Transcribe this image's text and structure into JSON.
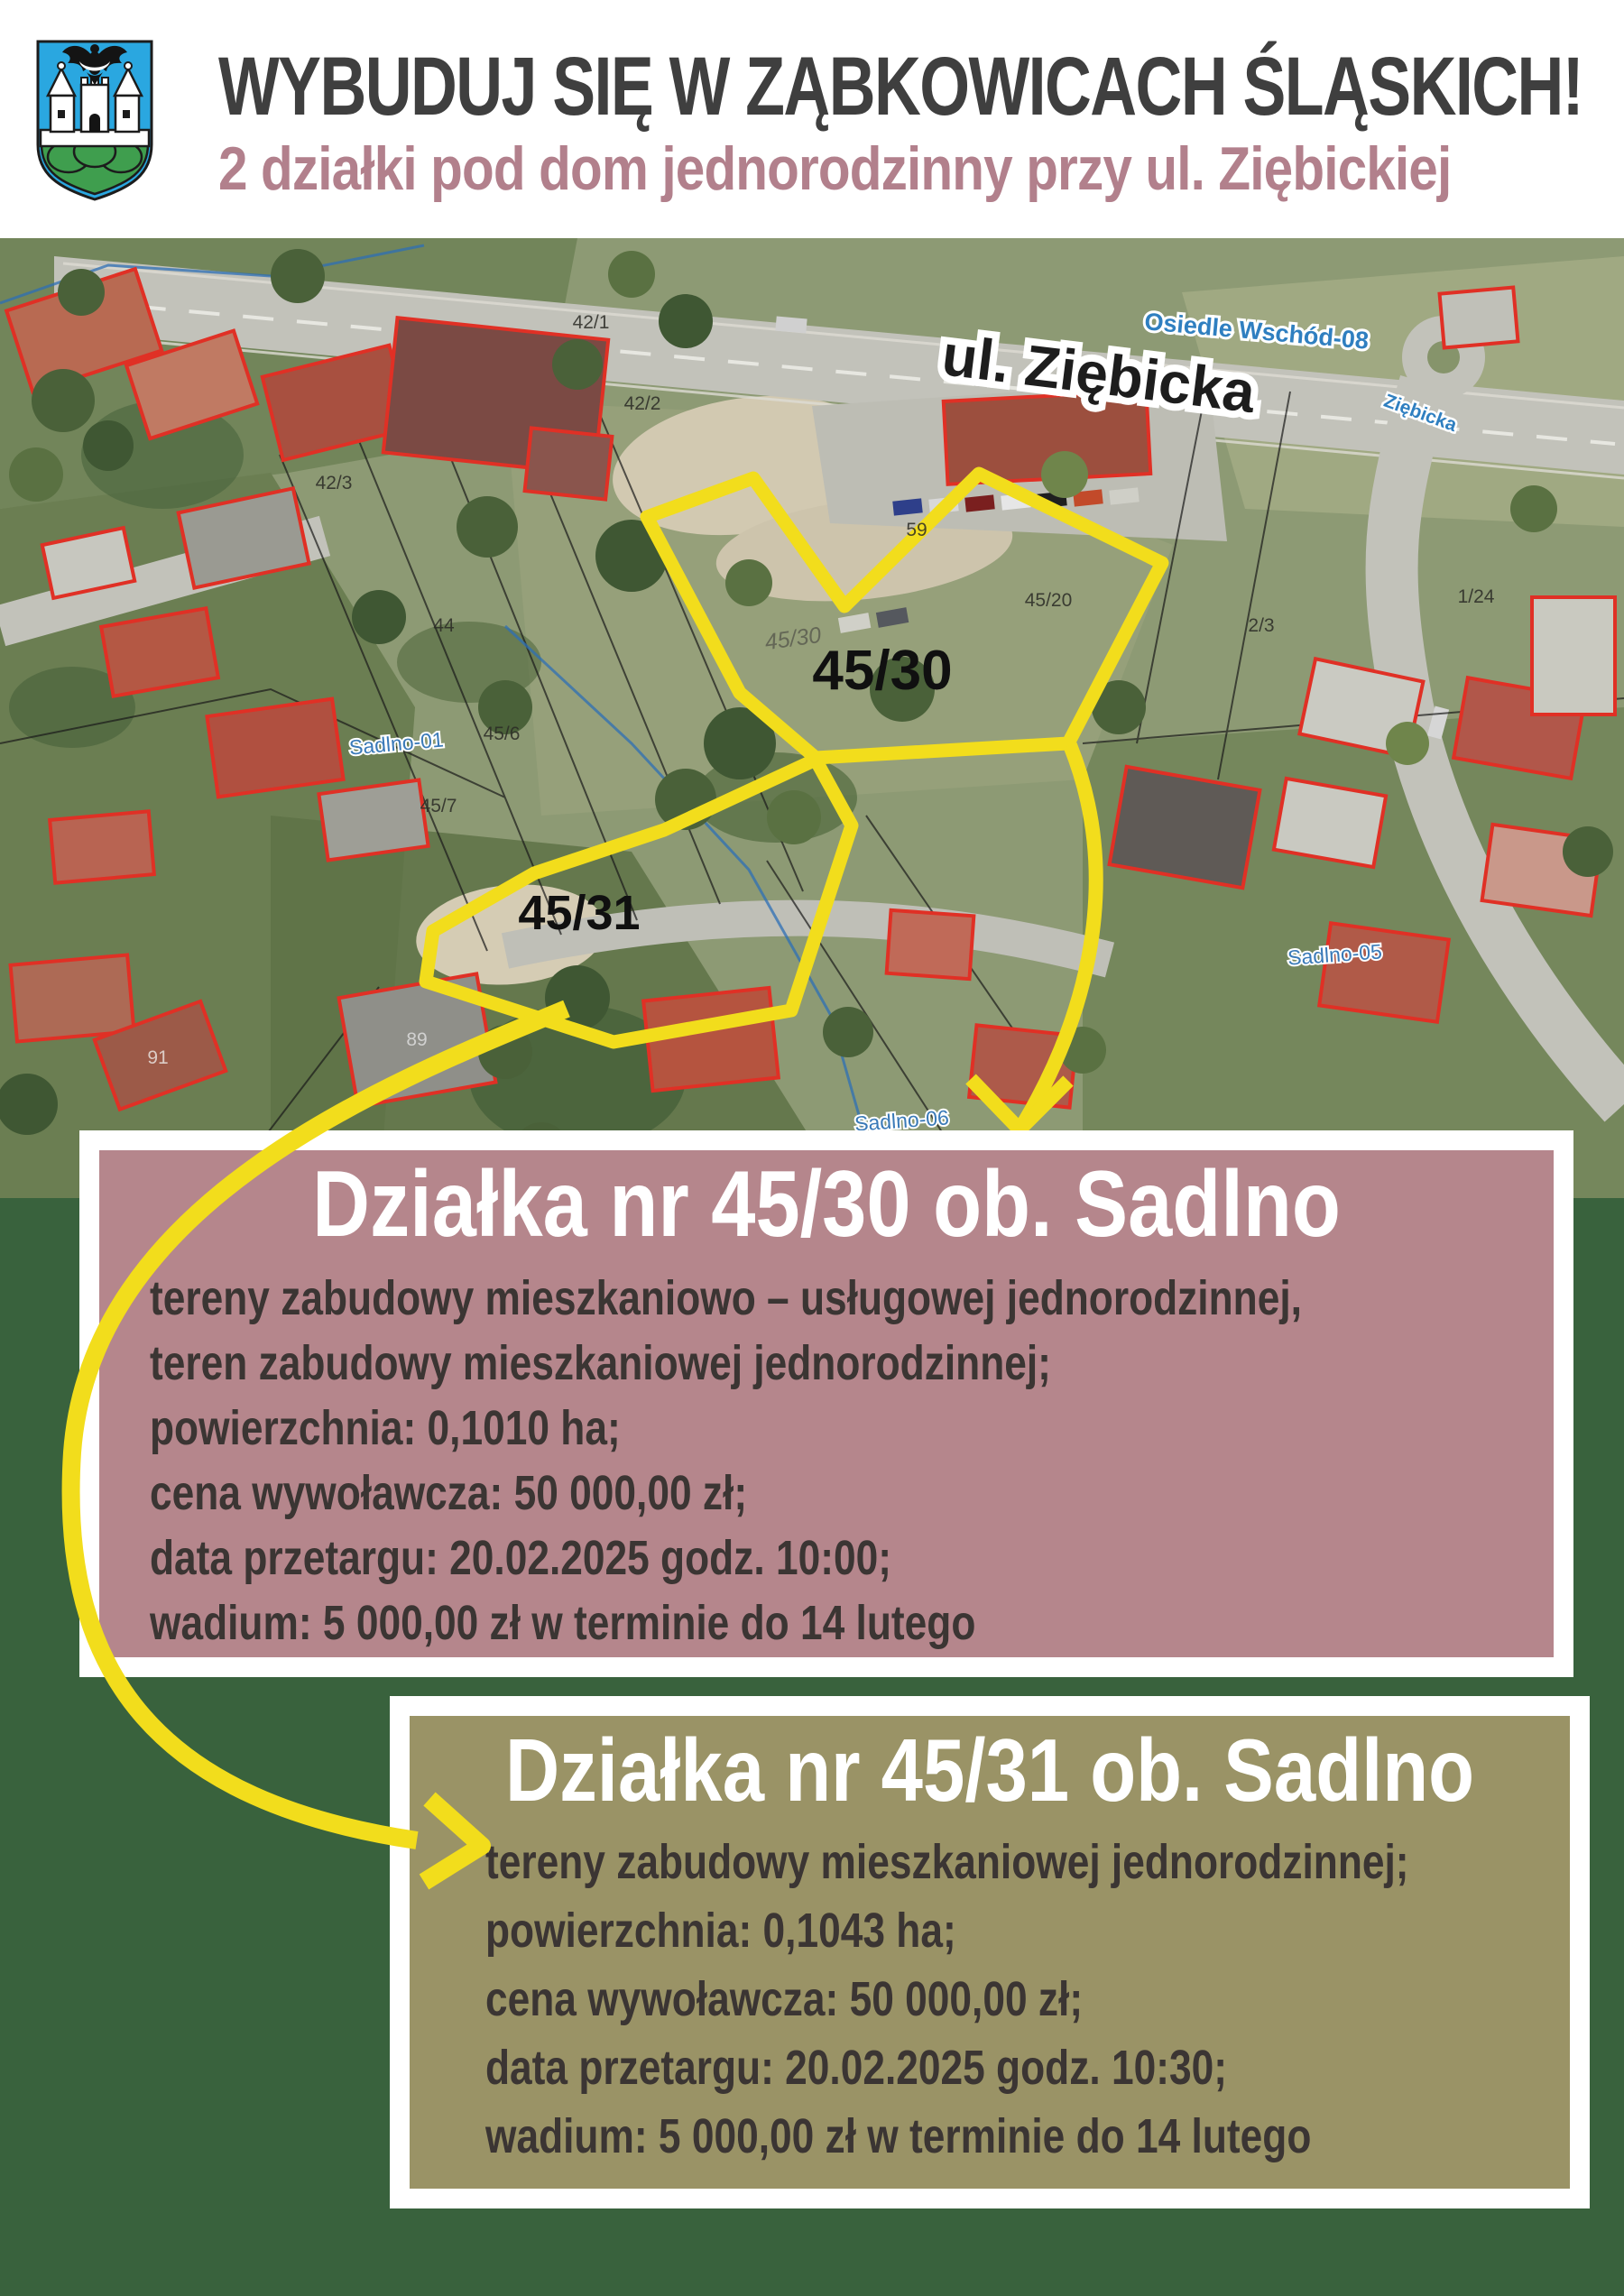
{
  "header": {
    "title": "WYBUDUJ SIĘ W ZĄBKOWICACH ŚLĄSKICH!",
    "subtitle": "2 działki pod dom jednorodzinny przy ul. Ziębickiej",
    "crest": {
      "field": "#2aa7e0",
      "hill": "#3f9e4e",
      "towers": "#ffffff",
      "eagle": "#141414"
    }
  },
  "map": {
    "street_label": "ul. Ziębicka",
    "settlement_label": "Osiedle Wschód-08",
    "street_label_small": "Ziębicka",
    "district_labels": [
      "Sadlno-01",
      "Sadlno-05",
      "Sadlno-06"
    ],
    "plot_labels": [
      "45/30",
      "45/31"
    ],
    "plot_label_faint": "45/30",
    "parcel_numbers": [
      "42/1",
      "42/2",
      "42/3",
      "44",
      "45/6",
      "45/7",
      "45/20",
      "59",
      "2/3",
      "1/24",
      "91",
      "89"
    ]
  },
  "plot_boxes": [
    {
      "title": "Działka nr 45/30 ob. Sadlno",
      "lines": [
        "tereny zabudowy mieszkaniowo – usługowej jednorodzinnej,",
        "teren zabudowy mieszkaniowej jednorodzinnej;",
        "powierzchnia: 0,1010 ha;",
        "cena wywoławcza: 50 000,00 zł;",
        "data przetargu: 20.02.2025 godz. 10:00;",
        "wadium: 5 000,00 zł w terminie do 14 lutego"
      ],
      "bg_color": "#b5868c"
    },
    {
      "title": "Działka nr 45/31 ob. Sadlno",
      "lines": [
        "tereny zabudowy mieszkaniowej jednorodzinnej;",
        "powierzchnia: 0,1043 ha;",
        "cena wywoławcza: 50 000,00 zł;",
        "data przetargu: 20.02.2025 godz. 10:30;",
        "wadium: 5 000,00 zł w terminie do 14 lutego"
      ],
      "bg_color": "#9a9366"
    }
  ],
  "colors": {
    "accent_yellow": "#f2dd1c",
    "bottom_background": "#39623d",
    "subtitle_text": "#b2808c",
    "building_outline_red": "#e03025"
  }
}
